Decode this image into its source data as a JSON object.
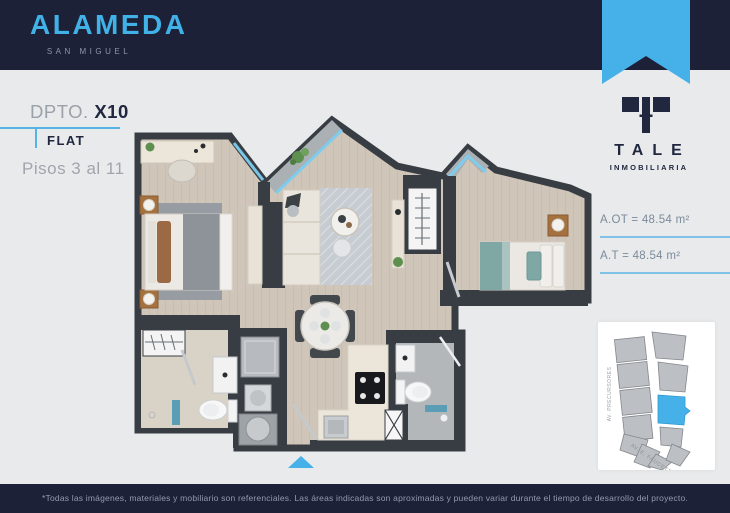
{
  "colors": {
    "navy": "#1c2138",
    "accent_blue": "#45b1e8",
    "rule_blue": "#56b4e4",
    "wall": "#383d43",
    "wood_floor": "#cfc5b9"
  },
  "header": {
    "title": "ALAMEDA",
    "subtitle": "SAN MIGUEL"
  },
  "unit": {
    "label": "DPTO.",
    "code": "X10",
    "type": "FLAT",
    "floors": "Pisos 3 al 11"
  },
  "brand": {
    "name": "TALE",
    "tagline": "INMOBILIARIA"
  },
  "areas": {
    "rows": [
      {
        "text": "A.OT = 48.54 m²"
      },
      {
        "text": "A.T = 48.54 m²"
      }
    ]
  },
  "map": {
    "street_left": "AV. PRECURSORES",
    "street_bottom": "AV. E. FAUCETT"
  },
  "footer": {
    "disclaimer": "*Todas las imágenes, materiales y mobiliario son referenciales. Las áreas indicadas son aproximadas y pueden variar durante el tiempo de desarrollo del proyecto."
  }
}
